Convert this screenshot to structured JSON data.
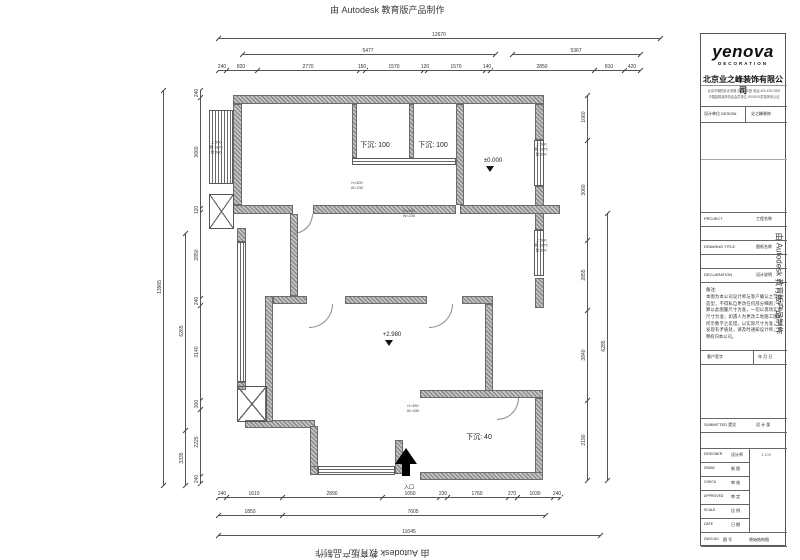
{
  "banners": {
    "text": "由 Autodesk 教育版产品制作"
  },
  "titleblock": {
    "logo": "yenova",
    "logo_sub": "DECORATION",
    "company": "北京业之峰装饰有限公司",
    "company_line1": "北京市朝阳区北苑路 凯旋城E座 电话:400-678-9009",
    "company_line2": "中国建筑装饰协会会员单位 ISO9001质量体系认证",
    "rowA_label": "设计单位 DESIGN",
    "rowA_value": "业之峰装饰",
    "project_en": "PROJECT",
    "project_cn": "工程名称",
    "title_en": "DRAWING TITLE",
    "title_cn": "图纸名称",
    "decl_en": "DECLARATION",
    "decl_cn": "设计说明",
    "notes_head": "备注:",
    "notes": "本图为本公司设计师与客户确认之节面造型，不得私自更改任何部分细则；结算以此图量尺寸为准，一切以现场实际尺寸为准；如遇人为更改工地施工图纸所示数字之差错，以实际尺寸为准；如发现有矛盾处，请及时通知设计师，解释权归本公司。",
    "sign_a": "客户签字",
    "sign_b": "年  月  日",
    "submitted_label": "SUBMITTED 提交",
    "submitted_value": "设 计 部",
    "table": [
      {
        "en": "DESIGNER",
        "cn": "设计师"
      },
      {
        "en": "DRAW",
        "cn": "制 图"
      },
      {
        "en": "CHECK",
        "cn": "审 核"
      },
      {
        "en": "APPROVED",
        "cn": "审 定"
      },
      {
        "en": "SCALE",
        "cn": "比 例"
      },
      {
        "en": "DATE",
        "cn": "日 期"
      }
    ],
    "scale_value": "1:100",
    "dwg_en": "DWG.NO",
    "dwg_cn": "图 号",
    "dwg_value": "原始结构图"
  },
  "plan": {
    "dimensions": [
      {
        "o": "h",
        "x": 218,
        "y": 38,
        "len": 442,
        "ticks": [
          0,
          442
        ],
        "labels": [
          {
            "t": "12670",
            "at": 221
          }
        ]
      },
      {
        "o": "h",
        "x": 242,
        "y": 54,
        "len": 253,
        "ticks": [
          0,
          253
        ],
        "labels": [
          {
            "t": "5477",
            "at": 126
          }
        ]
      },
      {
        "o": "h",
        "x": 512,
        "y": 54,
        "len": 128,
        "ticks": [
          0,
          128
        ],
        "labels": [
          {
            "t": "5367",
            "at": 64
          }
        ]
      },
      {
        "o": "h",
        "x": 218,
        "y": 70,
        "len": 422,
        "ticks": [
          0,
          8,
          39,
          141,
          147,
          205,
          209,
          267,
          272,
          376,
          406,
          422
        ],
        "labels": [
          {
            "t": "240",
            "at": 4
          },
          {
            "t": "820",
            "at": 23
          },
          {
            "t": "2770",
            "at": 90
          },
          {
            "t": "150",
            "at": 144
          },
          {
            "t": "1570",
            "at": 176
          },
          {
            "t": "120",
            "at": 207
          },
          {
            "t": "1570",
            "at": 238
          },
          {
            "t": "140",
            "at": 269
          },
          {
            "t": "2850",
            "at": 324
          },
          {
            "t": "810",
            "at": 391
          },
          {
            "t": "420",
            "at": 414
          }
        ]
      },
      {
        "o": "h",
        "x": 218,
        "y": 497,
        "len": 342,
        "ticks": [
          0,
          8,
          64,
          164,
          221,
          229,
          290,
          299,
          335,
          342
        ],
        "labels": [
          {
            "t": "240",
            "at": 4
          },
          {
            "t": "1610",
            "at": 36
          },
          {
            "t": "2890",
            "at": 114
          },
          {
            "t": "1650",
            "at": 192
          },
          {
            "t": "230",
            "at": 225
          },
          {
            "t": "1760",
            "at": 259
          },
          {
            "t": "270",
            "at": 294
          },
          {
            "t": "1030",
            "at": 317
          },
          {
            "t": "240",
            "at": 339
          }
        ]
      },
      {
        "o": "h",
        "x": 218,
        "y": 515,
        "len": 327,
        "ticks": [
          0,
          64,
          327
        ],
        "labels": [
          {
            "t": "1850",
            "at": 32
          },
          {
            "t": "7605",
            "at": 195
          }
        ]
      },
      {
        "o": "h",
        "x": 218,
        "y": 535,
        "len": 382,
        "ticks": [
          0,
          382
        ],
        "labels": [
          {
            "t": "11045",
            "at": 191
          }
        ]
      },
      {
        "o": "v",
        "x": 163,
        "y": 90,
        "len": 395,
        "ticks": [
          0,
          395
        ],
        "labels": [
          {
            "t": "13965",
            "at": 197
          }
        ]
      },
      {
        "o": "v",
        "x": 185,
        "y": 233,
        "len": 252,
        "ticks": [
          0,
          197,
          252
        ],
        "labels": [
          {
            "t": "6265",
            "at": 98
          },
          {
            "t": "3335",
            "at": 225
          }
        ]
      },
      {
        "o": "v",
        "x": 200,
        "y": 90,
        "len": 393,
        "ticks": [
          0,
          7,
          118,
          122,
          208,
          215,
          310,
          319,
          386,
          393
        ],
        "labels": [
          {
            "t": "240",
            "at": 3
          },
          {
            "t": "3660",
            "at": 62
          },
          {
            "t": "120",
            "at": 120
          },
          {
            "t": "2850",
            "at": 165
          },
          {
            "t": "240",
            "at": 211
          },
          {
            "t": "3140",
            "at": 262
          },
          {
            "t": "300",
            "at": 314
          },
          {
            "t": "2225",
            "at": 352
          },
          {
            "t": "240",
            "at": 389
          }
        ]
      },
      {
        "o": "v",
        "x": 587,
        "y": 95,
        "len": 385,
        "ticks": [
          0,
          45,
          145,
          215,
          305,
          385
        ],
        "labels": [
          {
            "t": "1060",
            "at": 22
          },
          {
            "t": "3060",
            "at": 95
          },
          {
            "t": "2855",
            "at": 180
          },
          {
            "t": "3840",
            "at": 260
          },
          {
            "t": "2190",
            "at": 345
          }
        ]
      },
      {
        "o": "v",
        "x": 607,
        "y": 213,
        "len": 267,
        "ticks": [
          0,
          267
        ],
        "labels": [
          {
            "t": "6285",
            "at": 133
          }
        ]
      }
    ],
    "annotations": [
      {
        "t": "下沉: 100",
        "x": 375,
        "y": 145,
        "c": "a-sunken"
      },
      {
        "t": "下沉: 100",
        "x": 433,
        "y": 145,
        "c": "a-sunken"
      },
      {
        "t": "下沉: 40",
        "x": 479,
        "y": 437,
        "c": "a-sunken"
      },
      {
        "t": "±0.000",
        "x": 493,
        "y": 161,
        "c": "a-level"
      },
      {
        "t": "+2.980",
        "x": 392,
        "y": 335,
        "c": "a-level"
      },
      {
        "t": "H=300",
        "x": 357,
        "y": 183,
        "c": "a-beam"
      },
      {
        "t": "W=230",
        "x": 357,
        "y": 188,
        "c": "a-beam"
      },
      {
        "t": "H=300",
        "x": 409,
        "y": 211,
        "c": "a-beam"
      },
      {
        "t": "W=230",
        "x": 409,
        "y": 216,
        "c": "a-beam"
      },
      {
        "t": "H=350",
        "x": 413,
        "y": 406,
        "c": "a-beam"
      },
      {
        "t": "W=430",
        "x": 413,
        "y": 411,
        "c": "a-beam"
      },
      {
        "t": "上:500",
        "x": 216,
        "y": 143,
        "c": "a-win"
      },
      {
        "t": "高:1875",
        "x": 216,
        "y": 148,
        "c": "a-win"
      },
      {
        "t": "台:500",
        "x": 216,
        "y": 153,
        "c": "a-win"
      },
      {
        "t": "上:500",
        "x": 541,
        "y": 145,
        "c": "a-win"
      },
      {
        "t": "高:1875",
        "x": 541,
        "y": 150,
        "c": "a-win"
      },
      {
        "t": "台:500",
        "x": 541,
        "y": 155,
        "c": "a-win"
      },
      {
        "t": "上:500",
        "x": 541,
        "y": 241,
        "c": "a-win"
      },
      {
        "t": "高:1875",
        "x": 541,
        "y": 246,
        "c": "a-win"
      },
      {
        "t": "台:500",
        "x": 541,
        "y": 251,
        "c": "a-win"
      },
      {
        "t": "入口",
        "x": 409,
        "y": 487,
        "c": "a-entry"
      }
    ]
  }
}
